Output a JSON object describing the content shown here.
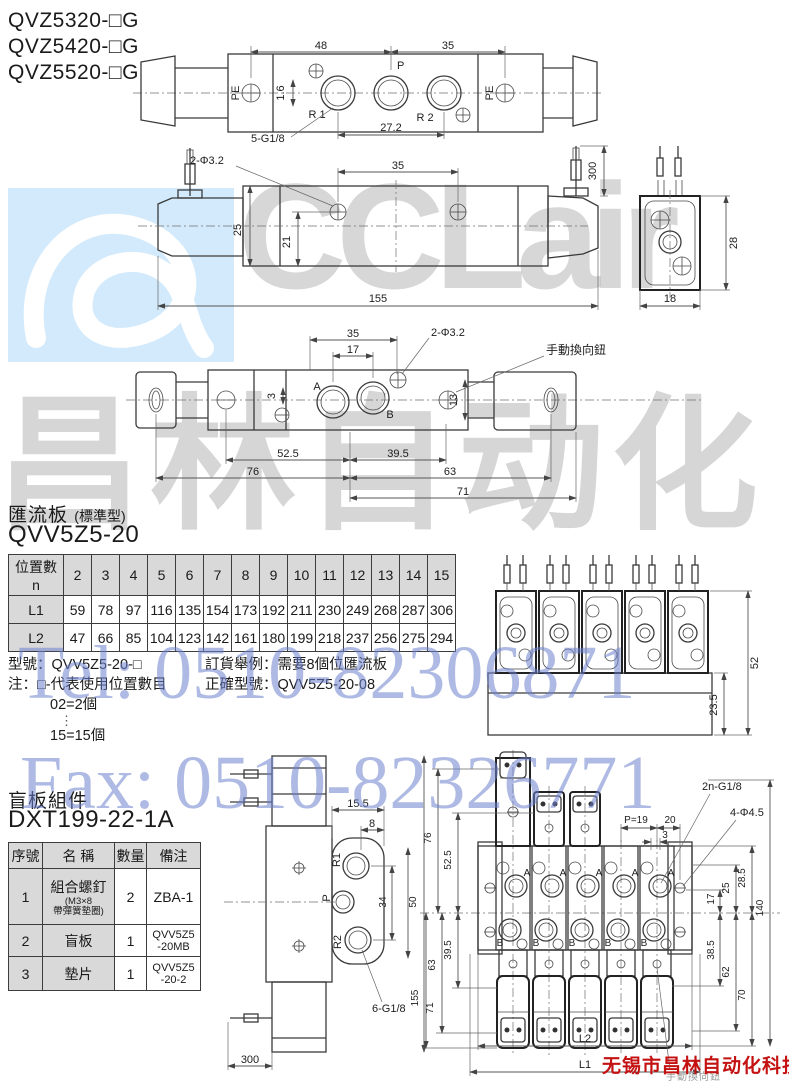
{
  "header": {
    "models": [
      "QVZ5320-□G",
      "QVZ5420-□G",
      "QVZ5520-□G"
    ]
  },
  "watermarks": {
    "tel": "Tel: 0510-82306871",
    "fax": "Fax: 0510-82326771",
    "brand_latin": "CCLair",
    "brand_cn": "昌林自动化",
    "company": "无锡市昌林自动化科技"
  },
  "drawing_top": {
    "dim_48": "48",
    "dim_35": "35",
    "port_pe_left": "PE",
    "port_p": "P",
    "port_r1": "R 1",
    "port_r2": "R 2",
    "port_pe_right": "PE",
    "dim_1_6": "1.6",
    "thread_note": "5-G1/8",
    "dim_27_2": "27.2"
  },
  "drawing_side": {
    "hole_note": "2-Φ3.2",
    "dim_35": "35",
    "dim_300": "300",
    "dim_25": "25",
    "dim_21": "21",
    "dim_155": "155"
  },
  "drawing_end": {
    "dim_28": "28",
    "dim_18": "18"
  },
  "drawing_bottom": {
    "dim_35": "35",
    "dim_17": "17",
    "hole_note": "2-Φ3.2",
    "manual_note": "手動換向鈕",
    "port_a": "A",
    "port_b": "B",
    "dim_3": "3",
    "dim_13": "13",
    "dim_52_5": "52.5",
    "dim_39_5": "39.5",
    "dim_76": "76",
    "dim_63": "63",
    "dim_71": "71"
  },
  "manifold_section": {
    "title": "匯流板",
    "title_sub": "(標準型)",
    "model": "QVV5Z5-20",
    "table": {
      "corner_top": "位置數",
      "corner_bottom": "n",
      "positions": [
        "2",
        "3",
        "4",
        "5",
        "6",
        "7",
        "8",
        "9",
        "10",
        "11",
        "12",
        "13",
        "14",
        "15"
      ],
      "l1_label": "L1",
      "l1": [
        "59",
        "78",
        "97",
        "116",
        "135",
        "154",
        "173",
        "192",
        "211",
        "230",
        "249",
        "268",
        "287",
        "306"
      ],
      "l2_label": "L2",
      "l2": [
        "47",
        "66",
        "85",
        "104",
        "123",
        "142",
        "161",
        "180",
        "199",
        "218",
        "237",
        "256",
        "275",
        "294"
      ]
    },
    "note_model": "型號：QVV5Z5-20-□",
    "note_line1": "注：□-代表使用位置數目",
    "note_line2": "02=2個",
    "note_dots": "⋮",
    "note_line3": "15=15個",
    "order_line1": "訂貨舉例：需要8個位匯流板",
    "order_line2": "正確型號：QVV5Z5-20-08"
  },
  "drawing_manifold_front": {
    "dim_52": "52",
    "dim_23_5": "23.5"
  },
  "blank_section": {
    "title": "盲板組件",
    "model": "DXT199-22-1A",
    "table": {
      "h_no": "序號",
      "h_name": "名  稱",
      "h_qty": "數量",
      "h_note": "備注",
      "rows": [
        {
          "no": "1",
          "name": "組合螺釘",
          "name_sub1": "(M3×8",
          "name_sub2": "帶彈簧墊圈)",
          "qty": "2",
          "note": "ZBA-1",
          "note2": ""
        },
        {
          "no": "2",
          "name": "盲板",
          "name_sub1": "",
          "name_sub2": "",
          "qty": "1",
          "note": "QVV5Z5",
          "note2": "-20MB"
        },
        {
          "no": "3",
          "name": "墊片",
          "name_sub1": "",
          "name_sub2": "",
          "qty": "1",
          "note": "QVV5Z5",
          "note2": "-20-2"
        }
      ]
    }
  },
  "drawing_blank_side": {
    "dim_15_5": "15.5",
    "dim_8": "8",
    "port_r1": "R1",
    "port_p": "P",
    "port_r2": "R2",
    "dim_34": "34",
    "dim_50": "50",
    "dim_155": "155",
    "thread_note": "6-G1/8",
    "dim_300": "300"
  },
  "drawing_manifold_top": {
    "dim_76": "76",
    "dim_52_5": "52.5",
    "thread_note": "2n-G1/8",
    "dim_p19": "P=19",
    "dim_20": "20",
    "dim_3": "3",
    "hole_note": "4-Φ4.5",
    "dim_25": "25",
    "dim_28_5": "28.5",
    "dim_17": "17",
    "dim_140": "140",
    "dim_39_5": "39.5",
    "dim_63": "63",
    "dim_71": "71",
    "dim_38_5": "38.5",
    "dim_62": "62",
    "dim_70": "70",
    "dim_l2": "L2",
    "dim_l1": "L1",
    "port_a": "A",
    "port_b": "B",
    "manual_note": "手動換向鈕"
  }
}
